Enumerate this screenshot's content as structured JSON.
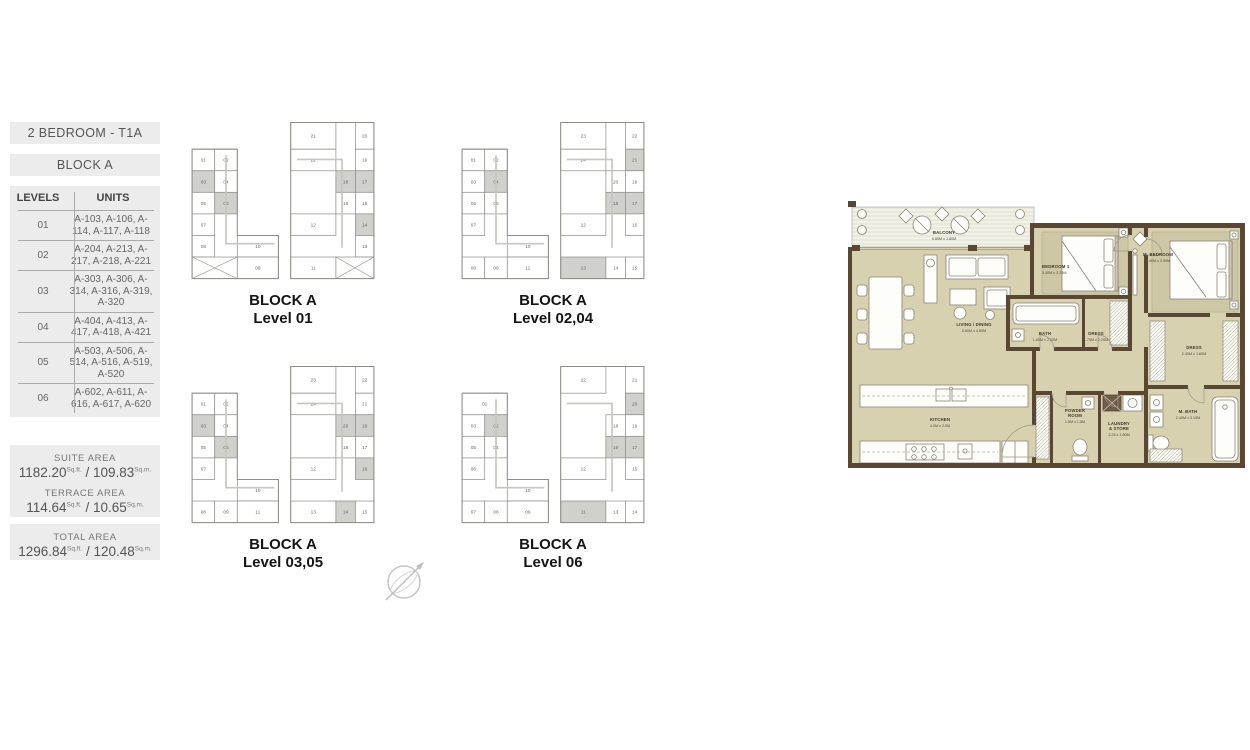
{
  "sidebar": {
    "title": "2 BEDROOM - T1A",
    "block": "BLOCK A",
    "table": {
      "headers": [
        "LEVELS",
        "UNITS"
      ],
      "rows": [
        {
          "level": "01",
          "units": "A-103, A-106, A-114, A-117, A-118"
        },
        {
          "level": "02",
          "units": "A-204, A-213, A-217, A-218, A-221"
        },
        {
          "level": "03",
          "units": "A-303, A-306, A-314, A-316, A-319, A-320"
        },
        {
          "level": "04",
          "units": "A-404, A-413, A-417, A-418, A-421"
        },
        {
          "level": "05",
          "units": "A-503, A-506, A-514, A-516, A-519, A-520"
        },
        {
          "level": "06",
          "units": "A-602, A-611, A-616, A-617, A-620"
        }
      ]
    },
    "areas": [
      {
        "label": "SUITE AREA",
        "sqft": "1182.20",
        "sqft_unit": "Sq.ft.",
        "sep": "/",
        "sqm": "109.83",
        "sqm_unit": "Sq.m."
      },
      {
        "label": "TERRACE AREA",
        "sqft": "114.64",
        "sqft_unit": "Sq.ft.",
        "sep": "/",
        "sqm": "10.65",
        "sqm_unit": "Sq.m."
      },
      {
        "label": "TOTAL AREA",
        "sqft": "1296.84",
        "sqft_unit": "Sq.ft.",
        "sep": "/",
        "sqm": "120.48",
        "sqm_unit": "Sq.m."
      }
    ]
  },
  "key_plans": [
    {
      "caption1": "BLOCK A",
      "caption2": "Level 01",
      "left": [
        [
          4,
          34,
          22,
          21,
          "01",
          ""
        ],
        [
          26,
          34,
          22,
          21,
          "02",
          ""
        ],
        [
          4,
          55,
          22,
          21,
          "03",
          "h"
        ],
        [
          26,
          55,
          22,
          21,
          "04",
          ""
        ],
        [
          4,
          76,
          22,
          21,
          "05",
          ""
        ],
        [
          26,
          76,
          22,
          21,
          "06",
          "h"
        ],
        [
          4,
          97,
          22,
          21,
          "07",
          ""
        ],
        [
          4,
          118,
          22,
          21,
          "08",
          ""
        ],
        [
          48,
          118,
          40,
          21,
          "10",
          ""
        ],
        [
          4,
          139,
          44,
          21,
          "",
          "x"
        ],
        [
          48,
          139,
          40,
          21,
          "09",
          ""
        ]
      ],
      "right": [
        [
          100,
          8,
          44,
          26,
          "21",
          ""
        ],
        [
          163,
          8,
          18,
          26,
          "20",
          ""
        ],
        [
          100,
          34,
          44,
          21,
          "22",
          ""
        ],
        [
          163,
          34,
          18,
          21,
          "19",
          ""
        ],
        [
          144,
          55,
          19,
          21,
          "18",
          "h"
        ],
        [
          163,
          55,
          18,
          21,
          "17",
          "h"
        ],
        [
          144,
          76,
          19,
          21,
          "16",
          ""
        ],
        [
          163,
          76,
          18,
          21,
          "15",
          ""
        ],
        [
          100,
          97,
          44,
          21,
          "12",
          ""
        ],
        [
          163,
          97,
          18,
          21,
          "14",
          "h"
        ],
        [
          163,
          118,
          18,
          21,
          "13",
          ""
        ],
        [
          100,
          139,
          44,
          21,
          "11",
          ""
        ],
        [
          144,
          139,
          37,
          21,
          "",
          "x"
        ]
      ]
    },
    {
      "caption1": "BLOCK A",
      "caption2": "Level 02,04",
      "left": [
        [
          4,
          34,
          22,
          21,
          "01",
          ""
        ],
        [
          26,
          34,
          22,
          21,
          "02",
          ""
        ],
        [
          4,
          55,
          22,
          21,
          "03",
          ""
        ],
        [
          26,
          55,
          22,
          21,
          "04",
          "h"
        ],
        [
          4,
          76,
          22,
          21,
          "05",
          ""
        ],
        [
          26,
          76,
          22,
          21,
          "06",
          ""
        ],
        [
          4,
          97,
          22,
          21,
          "07",
          ""
        ],
        [
          48,
          118,
          40,
          21,
          "10",
          ""
        ],
        [
          4,
          139,
          22,
          21,
          "08",
          ""
        ],
        [
          26,
          139,
          22,
          21,
          "09",
          ""
        ],
        [
          48,
          139,
          40,
          21,
          "11",
          ""
        ]
      ],
      "right": [
        [
          100,
          8,
          44,
          26,
          "23",
          ""
        ],
        [
          163,
          8,
          18,
          26,
          "22",
          ""
        ],
        [
          100,
          34,
          44,
          21,
          "24",
          ""
        ],
        [
          163,
          34,
          18,
          21,
          "21",
          "h"
        ],
        [
          144,
          55,
          19,
          21,
          "20",
          ""
        ],
        [
          163,
          55,
          18,
          21,
          "19",
          ""
        ],
        [
          144,
          76,
          19,
          21,
          "18",
          "h"
        ],
        [
          163,
          76,
          18,
          21,
          "17",
          "h"
        ],
        [
          100,
          97,
          44,
          21,
          "12",
          ""
        ],
        [
          163,
          97,
          18,
          21,
          "16",
          ""
        ],
        [
          100,
          139,
          44,
          21,
          "13",
          "h"
        ],
        [
          144,
          139,
          19,
          21,
          "14",
          ""
        ],
        [
          163,
          139,
          18,
          21,
          "15",
          ""
        ]
      ]
    },
    {
      "caption1": "BLOCK A",
      "caption2": "Level 03,05",
      "left": [
        [
          4,
          34,
          22,
          21,
          "01",
          ""
        ],
        [
          26,
          34,
          22,
          21,
          "02",
          ""
        ],
        [
          4,
          55,
          22,
          21,
          "03",
          "h"
        ],
        [
          26,
          55,
          22,
          21,
          "04",
          ""
        ],
        [
          4,
          76,
          22,
          21,
          "05",
          ""
        ],
        [
          26,
          76,
          22,
          21,
          "06",
          "h"
        ],
        [
          4,
          97,
          22,
          21,
          "07",
          ""
        ],
        [
          48,
          118,
          40,
          21,
          "10",
          ""
        ],
        [
          4,
          139,
          22,
          21,
          "08",
          ""
        ],
        [
          26,
          139,
          22,
          21,
          "09",
          ""
        ],
        [
          48,
          139,
          40,
          21,
          "11",
          ""
        ]
      ],
      "right": [
        [
          100,
          8,
          44,
          26,
          "23",
          ""
        ],
        [
          163,
          8,
          18,
          26,
          "22",
          ""
        ],
        [
          100,
          34,
          44,
          21,
          "24",
          ""
        ],
        [
          163,
          34,
          18,
          21,
          "21",
          ""
        ],
        [
          144,
          55,
          19,
          21,
          "20",
          "h"
        ],
        [
          163,
          55,
          18,
          21,
          "19",
          "h"
        ],
        [
          144,
          76,
          19,
          21,
          "18",
          ""
        ],
        [
          163,
          76,
          18,
          21,
          "17",
          ""
        ],
        [
          100,
          97,
          44,
          21,
          "12",
          ""
        ],
        [
          163,
          97,
          18,
          21,
          "16",
          "h"
        ],
        [
          100,
          139,
          44,
          21,
          "13",
          ""
        ],
        [
          144,
          139,
          19,
          21,
          "14",
          "h"
        ],
        [
          163,
          139,
          18,
          21,
          "15",
          ""
        ]
      ]
    },
    {
      "caption1": "BLOCK A",
      "caption2": "Level 06",
      "left": [
        [
          4,
          34,
          44,
          21,
          "01",
          ""
        ],
        [
          4,
          55,
          22,
          21,
          "03",
          ""
        ],
        [
          26,
          55,
          22,
          21,
          "02",
          "h"
        ],
        [
          4,
          76,
          22,
          21,
          "05",
          ""
        ],
        [
          26,
          76,
          22,
          21,
          "04",
          ""
        ],
        [
          4,
          97,
          22,
          21,
          "06",
          ""
        ],
        [
          48,
          118,
          40,
          21,
          "10",
          ""
        ],
        [
          4,
          139,
          22,
          21,
          "07",
          ""
        ],
        [
          26,
          139,
          22,
          21,
          "08",
          ""
        ],
        [
          48,
          139,
          40,
          21,
          "09",
          ""
        ]
      ],
      "right": [
        [
          100,
          8,
          44,
          26,
          "22",
          ""
        ],
        [
          163,
          8,
          18,
          26,
          "21",
          ""
        ],
        [
          163,
          34,
          18,
          21,
          "20",
          "h"
        ],
        [
          144,
          55,
          19,
          21,
          "18",
          ""
        ],
        [
          163,
          55,
          18,
          21,
          "19",
          ""
        ],
        [
          144,
          76,
          19,
          21,
          "16",
          "h"
        ],
        [
          163,
          76,
          18,
          21,
          "17",
          "h"
        ],
        [
          163,
          97,
          18,
          21,
          "15",
          ""
        ],
        [
          100,
          97,
          44,
          21,
          "12",
          ""
        ],
        [
          100,
          139,
          44,
          21,
          "11",
          "h"
        ],
        [
          144,
          139,
          19,
          21,
          "13",
          ""
        ],
        [
          163,
          139,
          18,
          21,
          "14",
          ""
        ]
      ]
    }
  ],
  "floor_plan": {
    "colors": {
      "wall": "#5a4733",
      "floor": "#d7d1b0",
      "carpet": "#cdc7a6",
      "balcony": "#f1f1e5"
    },
    "rooms": [
      {
        "name": "BALCONY",
        "dim": "5.80M x 1.80M"
      },
      {
        "name": "LIVING / DINING",
        "dim": "5.80M x 4.60M"
      },
      {
        "name": "BEDROOM 1",
        "dim": "3.40M x 3.20M"
      },
      {
        "name": "M. BEDROOM",
        "dim": "3.40M x 3.90M"
      },
      {
        "name": "BATH",
        "dim": "1.80M x 2.20M"
      },
      {
        "name": "DRESS",
        "dim": "1.70M x 2.20M"
      },
      {
        "name": "KITCHEN",
        "dim": "4.0M x 2.0M"
      },
      {
        "name": "POWDER",
        "name2": "ROOM",
        "dim": "1.5M x 1.5M"
      },
      {
        "name": "LAUNDRY",
        "name2": "& STORE",
        "dim": "2.25 x 1.80M"
      },
      {
        "name": "DRESS",
        "dim": "2.40M x 1.60M"
      },
      {
        "name": "M. BATH",
        "dim": "2.40M x 3.10M"
      }
    ]
  }
}
